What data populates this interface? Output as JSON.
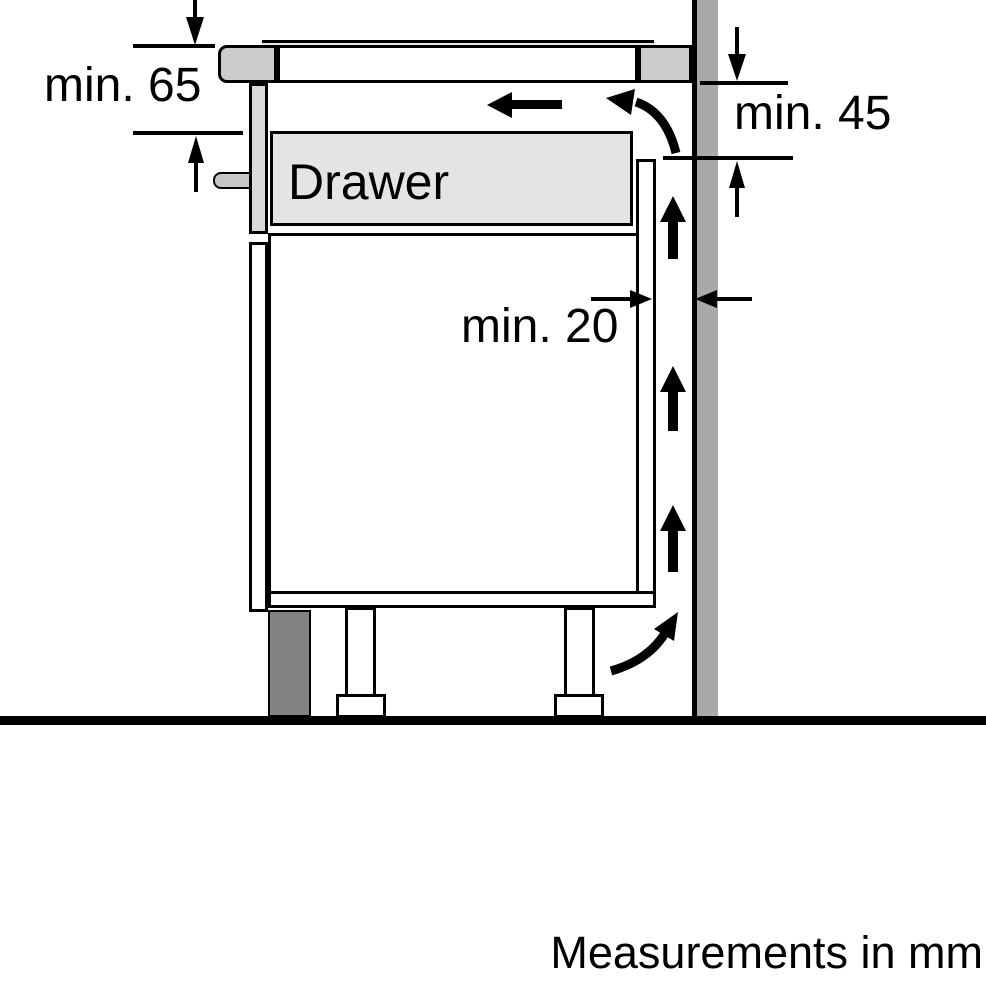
{
  "diagram": {
    "labels": {
      "drawer": "Drawer",
      "min65": "min. 65",
      "min45": "min. 45",
      "min20": "min. 20"
    },
    "footnote": "Measurements in mm",
    "colors": {
      "background": "#ffffff",
      "wall": "#a9a9a9",
      "worktop": "#cccccc",
      "drawer_fill": "#e4e4e4",
      "drawer_front": "#d9d9d9",
      "handle": "#c6c6c6",
      "plinth": "#838383",
      "line": "#000000"
    }
  }
}
